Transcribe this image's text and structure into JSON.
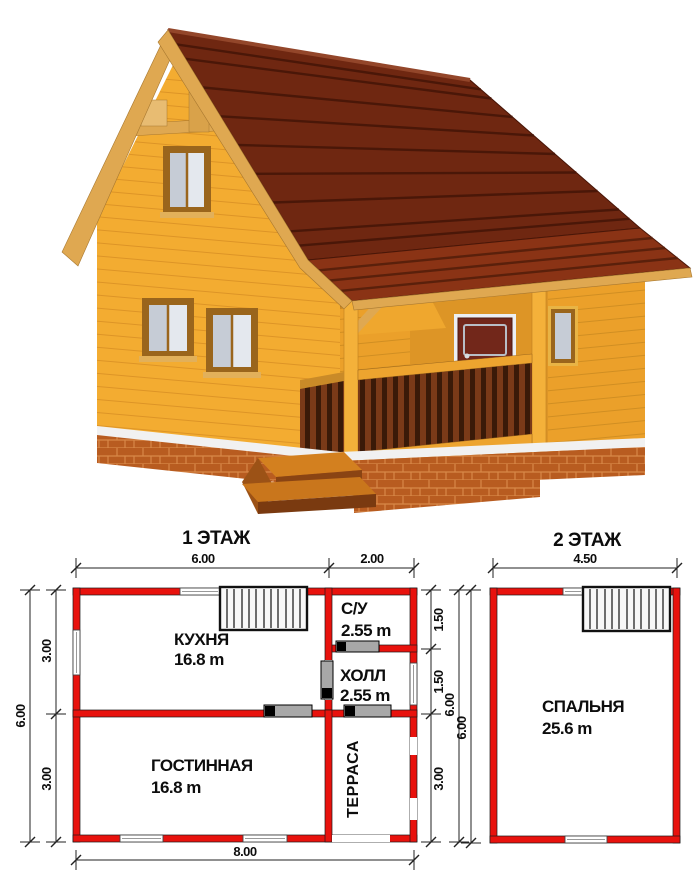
{
  "palette": {
    "plan_wall_red": "#e8120d",
    "roof_main": "#6f2711",
    "roof_porch": "#8a3315",
    "wall_wood_light": "#f3ac31",
    "wall_wood_dark": "#eba02a",
    "trim_wood": "#dfa851",
    "brick": "#b85c20",
    "door_maroon": "#72271a",
    "window_glass": "#c6ccd6"
  },
  "floor1": {
    "title": "1 ЭТАЖ",
    "kitchen": {
      "name": "КУХНЯ",
      "area": "16.8 m"
    },
    "bathroom": {
      "name": "С/У",
      "area": "2.55 m"
    },
    "hall": {
      "name": "ХОЛЛ",
      "area": "2.55 m"
    },
    "living": {
      "name": "ГОСТИННАЯ",
      "area": "16.8 m"
    },
    "terrace": {
      "name": "ТЕРРАСА"
    },
    "dims": {
      "top1": "6.00",
      "top2": "2.00",
      "bottom": "8.00",
      "left_outer": "6.00",
      "left_top": "3.00",
      "left_bottom": "3.00",
      "right_top": "1.50",
      "right_mid": "1.50",
      "right_bottom": "3.00",
      "right_outer": "6.00"
    }
  },
  "floor2": {
    "title": "2 ЭТАЖ",
    "bedroom": {
      "name": "СПАЛЬНЯ",
      "area": "25.6 m"
    },
    "dims": {
      "top": "4.50",
      "left": "6.00"
    }
  }
}
